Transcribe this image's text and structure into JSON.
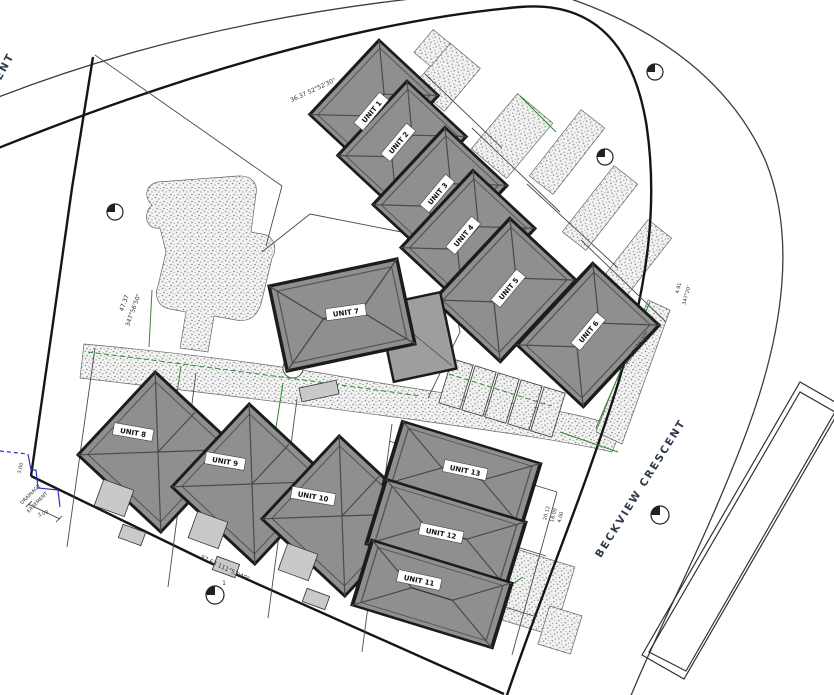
{
  "drawing": {
    "street_label": "BECKVIEW  CRESCENT",
    "street_left_partial": "ENT",
    "units": [
      {
        "label": "UNIT 1"
      },
      {
        "label": "UNIT 2"
      },
      {
        "label": "UNIT 3"
      },
      {
        "label": "UNIT 4"
      },
      {
        "label": "UNIT 5"
      },
      {
        "label": "UNIT 6"
      },
      {
        "label": "UNIT 7"
      },
      {
        "label": "UNIT 8"
      },
      {
        "label": "UNIT 9"
      },
      {
        "label": "UNIT 10"
      },
      {
        "label": "UNIT 11"
      },
      {
        "label": "UNIT 12"
      },
      {
        "label": "UNIT 13"
      }
    ],
    "dimensions": {
      "north": "36.37  52°52'30\"",
      "west_distance": "47.37",
      "west_bearing": "347°56'50\"",
      "south": "87.63  111°53'40\"",
      "east": "34.46  12°06'30\"",
      "east_short_distance": "4.91",
      "east_short_bearing": "347°20'",
      "easement_width_a": "3.00",
      "easement_width_b": "3.00",
      "lot_dims": [
        "20.12",
        "18.00",
        "4.00"
      ],
      "marker_number": "1"
    },
    "easement": {
      "line1": "DRAINAGE",
      "line2": "EASEMENT"
    },
    "colors": {
      "roof_fill": "#8f8f8f",
      "roof_outline": "#1c1c1c",
      "setback_green": "#2e8b2e",
      "easement_blue": "#2b35c0",
      "paper": "#ffffff"
    }
  }
}
